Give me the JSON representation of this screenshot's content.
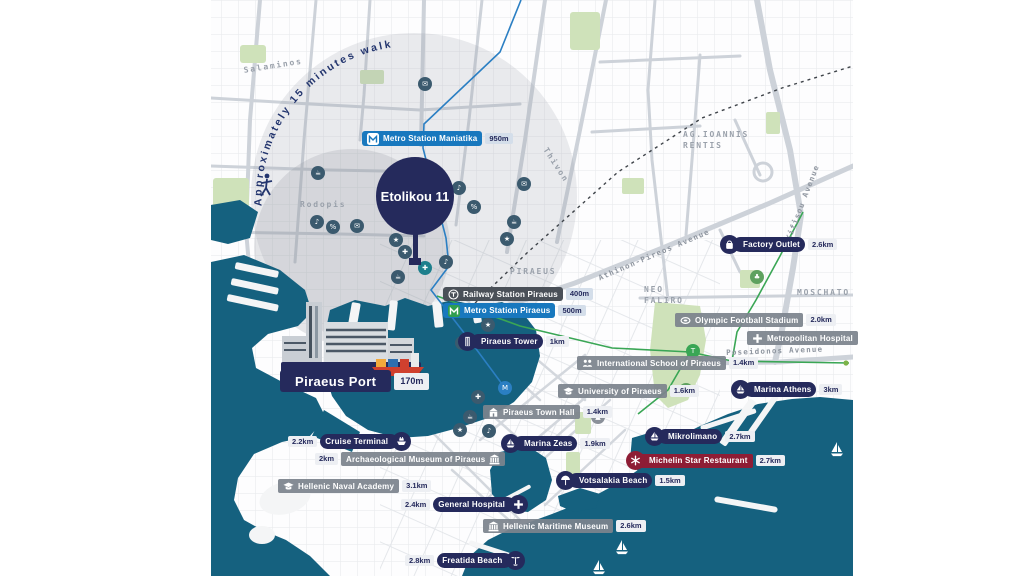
{
  "map": {
    "property": {
      "label": "Etolikou 11"
    },
    "walk_radius_note": "Approximately 15 minutes walk",
    "colors": {
      "navy": "#252a5c",
      "metro_blue": "#1878be",
      "rail_charcoal": "#4a5058",
      "badge_gray": "#7c838d",
      "michelin_red": "#8e1d35",
      "sea_teal": "#15617f",
      "park_green": "#cfe2ba",
      "tram_green": "#3aa655",
      "walk_text": "#23356e"
    },
    "pois": [
      {
        "label": "Metro Station Maniatika",
        "distance": "950m",
        "style": "metro",
        "icon": "metro-white",
        "icon_shape": "chip",
        "icon_side": "left",
        "dist_side": "right",
        "x": 362,
        "y": 131
      },
      {
        "label": "Railway Station Piraeus",
        "distance": "400m",
        "style": "rail",
        "icon": "rail",
        "icon_shape": "inline",
        "icon_side": "left",
        "dist_side": "right",
        "x": 443,
        "y": 287
      },
      {
        "label": "Metro Station Piraeus",
        "distance": "500m",
        "style": "metro",
        "icon": "metro-green",
        "icon_shape": "chip",
        "icon_side": "left",
        "dist_side": "right",
        "x": 443,
        "y": 303
      },
      {
        "label": "Piraeus Tower",
        "distance": "1km",
        "style": "navy",
        "icon": "building",
        "icon_shape": "circle",
        "icon_side": "left",
        "dist_side": "right",
        "x": 458,
        "y": 332
      },
      {
        "label": "Piraeus Port",
        "distance": "170m",
        "style": "port",
        "icon": "",
        "icon_shape": "none",
        "icon_side": "",
        "dist_side": "right",
        "x": 280,
        "y": 370
      },
      {
        "label": "Cruise Terminal",
        "distance": "2.2km",
        "style": "navy",
        "icon": "ship",
        "icon_shape": "circle",
        "icon_side": "right",
        "dist_side": "left",
        "x": 285,
        "y": 432
      },
      {
        "label": "Archaeological Museum of Piraeus",
        "distance": "2km",
        "style": "gray",
        "icon": "museum",
        "icon_shape": "inline",
        "icon_side": "right",
        "dist_side": "left",
        "x": 312,
        "y": 452
      },
      {
        "label": "Hellenic Naval Academy",
        "distance": "3.1km",
        "style": "gray",
        "icon": "cap",
        "icon_shape": "inline",
        "icon_side": "left",
        "dist_side": "right",
        "x": 278,
        "y": 479
      },
      {
        "label": "General Hospital",
        "distance": "2.4km",
        "style": "navy",
        "icon": "plus",
        "icon_shape": "circle",
        "icon_side": "right",
        "dist_side": "left",
        "x": 398,
        "y": 495
      },
      {
        "label": "Piraeus Town Hall",
        "distance": "1.4km",
        "style": "gray",
        "icon": "townhall",
        "icon_shape": "inline",
        "icon_side": "left",
        "dist_side": "right",
        "x": 483,
        "y": 405
      },
      {
        "label": "Marina Zeas",
        "distance": "1.9km",
        "style": "navy",
        "icon": "sail",
        "icon_shape": "circle",
        "icon_side": "left",
        "dist_side": "right",
        "x": 501,
        "y": 434
      },
      {
        "label": "University of Piraeus",
        "distance": "1.6km",
        "style": "gray",
        "icon": "cap",
        "icon_shape": "inline",
        "icon_side": "left",
        "dist_side": "right",
        "x": 558,
        "y": 384
      },
      {
        "label": "International School of Piraeus",
        "distance": "1.4km",
        "style": "gray",
        "icon": "school",
        "icon_shape": "inline",
        "icon_side": "left",
        "dist_side": "right",
        "x": 577,
        "y": 356
      },
      {
        "label": "Olympic Football Stadium",
        "distance": "2.0km",
        "style": "gray",
        "icon": "stadium",
        "icon_shape": "inline",
        "icon_side": "left",
        "dist_side": "right",
        "x": 675,
        "y": 313
      },
      {
        "label": "Metropolitan Hospital",
        "distance": "",
        "style": "gray",
        "icon": "plus-gray",
        "icon_shape": "inline",
        "icon_side": "left",
        "dist_side": "right",
        "x": 747,
        "y": 331
      },
      {
        "label": "Marina Athens",
        "distance": "3km",
        "style": "navy",
        "icon": "sail",
        "icon_shape": "circle",
        "icon_side": "left",
        "dist_side": "right",
        "x": 731,
        "y": 380
      },
      {
        "label": "Factory Outlet",
        "distance": "2.6km",
        "style": "navy",
        "icon": "bag",
        "icon_shape": "circle",
        "icon_side": "left",
        "dist_side": "right",
        "x": 720,
        "y": 235
      },
      {
        "label": "Mikrolimano",
        "distance": "2.7km",
        "style": "navy",
        "icon": "sail",
        "icon_shape": "circle",
        "icon_side": "left",
        "dist_side": "right",
        "x": 645,
        "y": 427
      },
      {
        "label": "Michelin Star Restaurant",
        "distance": "2.7km",
        "style": "red",
        "icon": "star",
        "icon_shape": "circle",
        "icon_side": "left",
        "dist_side": "right",
        "x": 626,
        "y": 451
      },
      {
        "label": "Votsalakia Beach",
        "distance": "1.5km",
        "style": "navy",
        "icon": "umbrella",
        "icon_shape": "circle",
        "icon_side": "left",
        "dist_side": "right",
        "x": 556,
        "y": 471
      },
      {
        "label": "Hellenic Maritime Museum",
        "distance": "2.6km",
        "style": "gray",
        "icon": "museum",
        "icon_shape": "inline",
        "icon_side": "left",
        "dist_side": "right",
        "x": 483,
        "y": 519
      },
      {
        "label": "Freatida Beach",
        "distance": "2.8km",
        "style": "navy",
        "icon": "palm",
        "icon_shape": "circle",
        "icon_side": "right",
        "dist_side": "left",
        "x": 402,
        "y": 551
      }
    ],
    "area_labels": [
      {
        "text": "Salaminos",
        "x": 243,
        "y": 66,
        "rot": -9,
        "cls": "area"
      },
      {
        "text": "Rodopis",
        "x": 300,
        "y": 200,
        "rot": 0,
        "cls": "area"
      },
      {
        "text": "Thivon",
        "x": 549,
        "y": 146,
        "rot": 57,
        "cls": "area"
      },
      {
        "text": "PIRAEUS",
        "x": 510,
        "y": 267,
        "rot": 0,
        "cls": "area"
      },
      {
        "text": "AG.IOANNIS\nRENTIS",
        "x": 683,
        "y": 130,
        "rot": 0,
        "cls": "area"
      },
      {
        "text": "NEO\nFALIRO",
        "x": 644,
        "y": 285,
        "rot": 0,
        "cls": "area"
      },
      {
        "text": "MOSCHATO",
        "x": 797,
        "y": 288,
        "rot": 0,
        "cls": "area"
      },
      {
        "text": "Athinon-Pireos Avenue",
        "x": 597,
        "y": 274,
        "rot": -23,
        "cls": "area avenue"
      },
      {
        "text": "Kifisou Avenue",
        "x": 784,
        "y": 238,
        "rot": -69,
        "cls": "area avenue"
      },
      {
        "text": "Poseidonos Avenue",
        "x": 726,
        "y": 348,
        "rot": -2,
        "cls": "area avenue"
      }
    ],
    "decor_icons": [
      {
        "glyph": "✉",
        "x": 425,
        "y": 84,
        "bg": "#3b5a6e"
      },
      {
        "glyph": "☕",
        "x": 318,
        "y": 173,
        "bg": "#3b5a6e"
      },
      {
        "glyph": "♪",
        "x": 459,
        "y": 188,
        "bg": "#3b5a6e"
      },
      {
        "glyph": "%",
        "x": 474,
        "y": 207,
        "bg": "#3b5a6e"
      },
      {
        "glyph": "✉",
        "x": 524,
        "y": 184,
        "bg": "#3b5a6e"
      },
      {
        "glyph": "☕",
        "x": 514,
        "y": 222,
        "bg": "#3b5a6e"
      },
      {
        "glyph": "★",
        "x": 507,
        "y": 239,
        "bg": "#3b5a6e"
      },
      {
        "glyph": "♪",
        "x": 317,
        "y": 222,
        "bg": "#3b5a6e"
      },
      {
        "glyph": "%",
        "x": 333,
        "y": 227,
        "bg": "#3b5a6e"
      },
      {
        "glyph": "✉",
        "x": 357,
        "y": 226,
        "bg": "#3b5a6e"
      },
      {
        "glyph": "★",
        "x": 396,
        "y": 240,
        "bg": "#3b5a6e"
      },
      {
        "glyph": "✚",
        "x": 405,
        "y": 252,
        "bg": "#3b5a6e"
      },
      {
        "glyph": "☕",
        "x": 398,
        "y": 277,
        "bg": "#3b5a6e"
      },
      {
        "glyph": "♪",
        "x": 446,
        "y": 262,
        "bg": "#3b5a6e"
      },
      {
        "glyph": "★",
        "x": 488,
        "y": 325,
        "bg": "#3b5a6e"
      },
      {
        "glyph": "✉",
        "x": 462,
        "y": 343,
        "bg": "#3b5a6e"
      },
      {
        "glyph": "✚",
        "x": 478,
        "y": 397,
        "bg": "#3b5a6e"
      },
      {
        "glyph": "☕",
        "x": 470,
        "y": 417,
        "bg": "#3b5a6e"
      },
      {
        "glyph": "♪",
        "x": 489,
        "y": 431,
        "bg": "#3b5a6e"
      },
      {
        "glyph": "★",
        "x": 460,
        "y": 430,
        "bg": "#3b5a6e"
      },
      {
        "glyph": "▲",
        "x": 598,
        "y": 417,
        "bg": "#8a9099"
      },
      {
        "glyph": "✚",
        "x": 425,
        "y": 268,
        "bg": "#1d7f8c"
      },
      {
        "glyph": "M",
        "x": 505,
        "y": 388,
        "bg": "#2b7fc3"
      },
      {
        "glyph": "T",
        "x": 693,
        "y": 351,
        "bg": "#3aa655"
      },
      {
        "glyph": "♣",
        "x": 686,
        "y": 390,
        "bg": "#5ea15f"
      },
      {
        "glyph": "♣",
        "x": 757,
        "y": 277,
        "bg": "#5ea15f"
      }
    ],
    "sailboats": [
      {
        "x": 830,
        "y": 442
      },
      {
        "x": 615,
        "y": 540
      },
      {
        "x": 592,
        "y": 560
      }
    ]
  }
}
